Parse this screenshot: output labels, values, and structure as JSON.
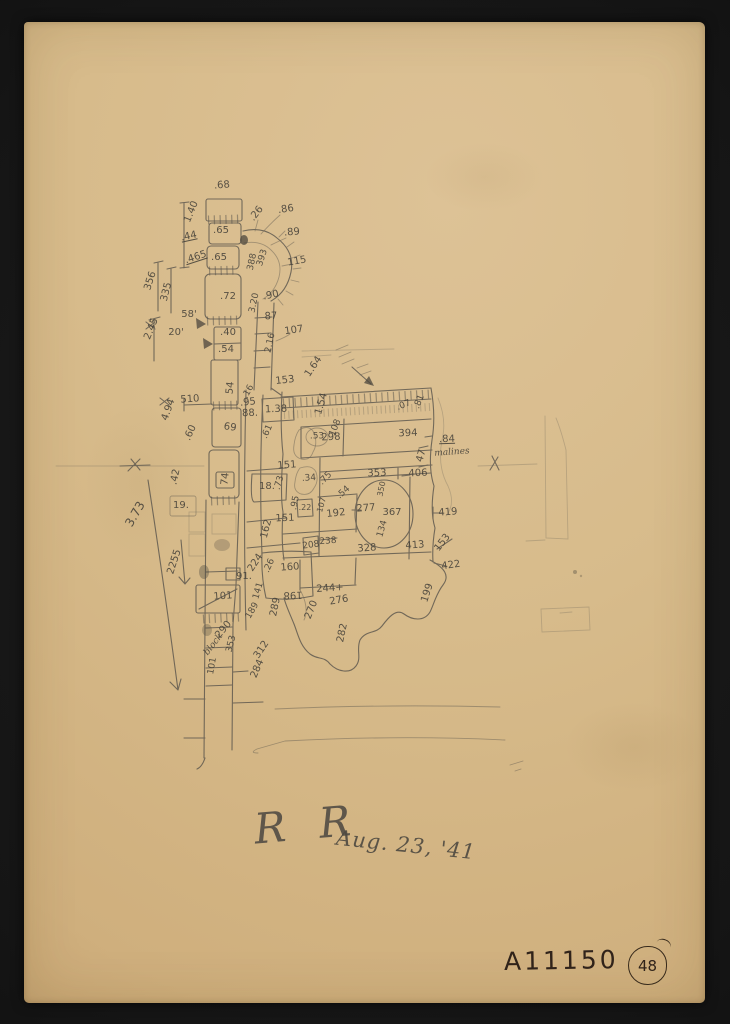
{
  "colors": {
    "scan_background": "#151515",
    "paper": "#d7bb8b",
    "pencil": "#54504a",
    "ink": "#30231a"
  },
  "signature": {
    "initials": "R R",
    "date": "Aug. 23, '41"
  },
  "catalog": {
    "number": "A11150",
    "page": "48"
  },
  "note": {
    "value": ".84",
    "word": "malines"
  },
  "labels": [
    {
      "t": ".68",
      "x": 222,
      "y": 186,
      "r": -5
    },
    {
      "t": "1.40",
      "x": 192,
      "y": 212,
      "r": -68
    },
    {
      "t": ".44",
      "x": 189,
      "y": 237,
      "r": -12,
      "u": 1
    },
    {
      "t": ".465",
      "x": 196,
      "y": 258,
      "r": -18,
      "u": 1
    },
    {
      "t": "356",
      "x": 151,
      "y": 281,
      "r": -72
    },
    {
      "t": "335",
      "x": 167,
      "y": 292,
      "r": -76
    },
    {
      "t": "2.45",
      "x": 152,
      "y": 329,
      "r": -68
    },
    {
      "t": ".65",
      "x": 221,
      "y": 231
    },
    {
      "t": ".65",
      "x": 219,
      "y": 258
    },
    {
      "t": ".72",
      "x": 228,
      "y": 297
    },
    {
      "t": "58'",
      "x": 189,
      "y": 315
    },
    {
      "t": "20'",
      "x": 176,
      "y": 333
    },
    {
      "t": ".26",
      "x": 257,
      "y": 214,
      "r": -52
    },
    {
      "t": ".86",
      "x": 286,
      "y": 210,
      "r": -8
    },
    {
      "t": ".89",
      "x": 292,
      "y": 233,
      "r": -5
    },
    {
      "t": "388",
      "x": 253,
      "y": 262,
      "r": -78,
      "s": 9
    },
    {
      "t": "393",
      "x": 263,
      "y": 258,
      "r": -72,
      "s": 9
    },
    {
      "t": "115",
      "x": 297,
      "y": 262,
      "r": -10
    },
    {
      "t": ".90",
      "x": 271,
      "y": 296,
      "r": -12
    },
    {
      "t": "3.20",
      "x": 255,
      "y": 303,
      "r": -78,
      "s": 9
    },
    {
      "t": "87",
      "x": 271,
      "y": 317,
      "r": -3
    },
    {
      "t": "107",
      "x": 294,
      "y": 331,
      "r": -8
    },
    {
      "t": "2.16",
      "x": 271,
      "y": 343,
      "r": -78,
      "s": 9
    },
    {
      "t": ".40",
      "x": 228,
      "y": 333
    },
    {
      "t": ".54",
      "x": 226,
      "y": 350
    },
    {
      "t": "54",
      "x": 231,
      "y": 388,
      "r": -84
    },
    {
      "t": "510",
      "x": 190,
      "y": 400,
      "r": -4
    },
    {
      "t": "4.94",
      "x": 169,
      "y": 410,
      "r": -70
    },
    {
      "t": ".60",
      "x": 191,
      "y": 433,
      "r": -66
    },
    {
      "t": "69",
      "x": 230,
      "y": 428,
      "r": 8
    },
    {
      "t": "74",
      "x": 226,
      "y": 479,
      "r": -84
    },
    {
      "t": ".42",
      "x": 176,
      "y": 477,
      "r": -78
    },
    {
      "t": "19.",
      "x": 181,
      "y": 506
    },
    {
      "t": "3.73",
      "x": 135,
      "y": 514,
      "r": -60,
      "s": 12
    },
    {
      "t": "2255",
      "x": 175,
      "y": 562,
      "r": -72
    },
    {
      "t": ".16",
      "x": 249,
      "y": 392,
      "r": -62,
      "s": 9
    },
    {
      "t": ".95",
      "x": 248,
      "y": 403,
      "r": -6
    },
    {
      "t": "88.",
      "x": 250,
      "y": 414,
      "r": -2
    },
    {
      "t": "1.38",
      "x": 276,
      "y": 410,
      "r": -2
    },
    {
      "t": "153",
      "x": 285,
      "y": 381,
      "r": -6
    },
    {
      "t": "1.64",
      "x": 314,
      "y": 367,
      "r": -56
    },
    {
      "t": "1.54",
      "x": 322,
      "y": 404,
      "r": -74
    },
    {
      "t": ".61",
      "x": 268,
      "y": 432,
      "r": -66,
      "s": 9
    },
    {
      "t": "108",
      "x": 336,
      "y": 428,
      "r": -68,
      "s": 9
    },
    {
      "t": ".53",
      "x": 317,
      "y": 437,
      "s": 9
    },
    {
      "t": "298",
      "x": 331,
      "y": 438,
      "r": -2
    },
    {
      "t": "394",
      "x": 408,
      "y": 434,
      "r": -2
    },
    {
      "t": ".07",
      "x": 404,
      "y": 406,
      "r": -22,
      "s": 9
    },
    {
      "t": ".81",
      "x": 420,
      "y": 402,
      "r": -68,
      "s": 9
    },
    {
      "t": "47",
      "x": 422,
      "y": 456,
      "r": -74
    },
    {
      "t": ".84",
      "x": 447,
      "y": 440,
      "r": -2,
      "u": 1
    },
    {
      "t": "malines",
      "x": 452,
      "y": 453,
      "r": -4,
      "s": 9,
      "f": "cursive"
    },
    {
      "t": "151",
      "x": 287,
      "y": 466,
      "r": -4
    },
    {
      "t": "18.",
      "x": 267,
      "y": 487
    },
    {
      "t": ".73",
      "x": 280,
      "y": 483,
      "r": -74,
      "s": 9
    },
    {
      "t": ".34",
      "x": 309,
      "y": 479,
      "r": -4,
      "s": 9
    },
    {
      "t": ".75",
      "x": 326,
      "y": 479,
      "r": -46,
      "s": 9
    },
    {
      "t": ".54",
      "x": 344,
      "y": 493,
      "r": -42,
      "s": 9
    },
    {
      "t": ".95",
      "x": 296,
      "y": 503,
      "r": -78,
      "s": 9
    },
    {
      "t": ".22",
      "x": 305,
      "y": 508,
      "s": 8
    },
    {
      "t": "107",
      "x": 322,
      "y": 505,
      "r": -74,
      "s": 8
    },
    {
      "t": "192",
      "x": 336,
      "y": 514,
      "r": -6
    },
    {
      "t": "151",
      "x": 285,
      "y": 519,
      "r": -2
    },
    {
      "t": "162",
      "x": 267,
      "y": 529,
      "r": -76
    },
    {
      "t": "277",
      "x": 366,
      "y": 509,
      "r": -4
    },
    {
      "t": "367",
      "x": 392,
      "y": 513
    },
    {
      "t": "134",
      "x": 383,
      "y": 529,
      "r": -74,
      "s": 9
    },
    {
      "t": "353",
      "x": 377,
      "y": 474,
      "r": -2
    },
    {
      "t": "350",
      "x": 382,
      "y": 489,
      "r": -78,
      "s": 8
    },
    {
      "t": "406",
      "x": 418,
      "y": 474,
      "r": -2
    },
    {
      "t": "419",
      "x": 448,
      "y": 513,
      "r": -4
    },
    {
      "t": "208",
      "x": 311,
      "y": 546,
      "r": -8,
      "s": 9
    },
    {
      "t": "238",
      "x": 328,
      "y": 542,
      "r": -4,
      "s": 9
    },
    {
      "t": "328",
      "x": 367,
      "y": 549,
      "r": -4
    },
    {
      "t": "413",
      "x": 415,
      "y": 546,
      "r": -4
    },
    {
      "t": "153",
      "x": 443,
      "y": 543,
      "r": -52
    },
    {
      "t": "422",
      "x": 451,
      "y": 566,
      "r": -8
    },
    {
      "t": "199",
      "x": 428,
      "y": 593,
      "r": -72
    },
    {
      "t": "244+",
      "x": 330,
      "y": 589,
      "r": -4
    },
    {
      "t": "276",
      "x": 339,
      "y": 601,
      "r": -10
    },
    {
      "t": "270",
      "x": 312,
      "y": 610,
      "r": -68
    },
    {
      "t": "282",
      "x": 343,
      "y": 633,
      "r": -78
    },
    {
      "t": "224",
      "x": 256,
      "y": 563,
      "r": -56
    },
    {
      "t": "91.",
      "x": 244,
      "y": 577
    },
    {
      "t": "101",
      "x": 223,
      "y": 597,
      "r": -4
    },
    {
      "t": "141",
      "x": 259,
      "y": 591,
      "r": -74,
      "s": 9
    },
    {
      "t": "289",
      "x": 276,
      "y": 607,
      "r": -78
    },
    {
      "t": ".26",
      "x": 270,
      "y": 566,
      "r": -66,
      "s": 9
    },
    {
      "t": "160",
      "x": 290,
      "y": 568,
      "r": -4
    },
    {
      "t": "198",
      "x": 293,
      "y": 594,
      "r": 178
    },
    {
      "t": "189",
      "x": 253,
      "y": 611,
      "r": -60,
      "s": 9
    },
    {
      "t": "290",
      "x": 224,
      "y": 630,
      "r": -50
    },
    {
      "t": "block",
      "x": 214,
      "y": 645,
      "r": -52,
      "s": 9,
      "f": "cursive"
    },
    {
      "t": "353",
      "x": 232,
      "y": 644,
      "r": -76,
      "s": 9
    },
    {
      "t": "312",
      "x": 262,
      "y": 650,
      "r": -56
    },
    {
      "t": "284",
      "x": 258,
      "y": 669,
      "r": -66
    },
    {
      "t": "101",
      "x": 213,
      "y": 666,
      "r": -80,
      "s": 9
    }
  ]
}
